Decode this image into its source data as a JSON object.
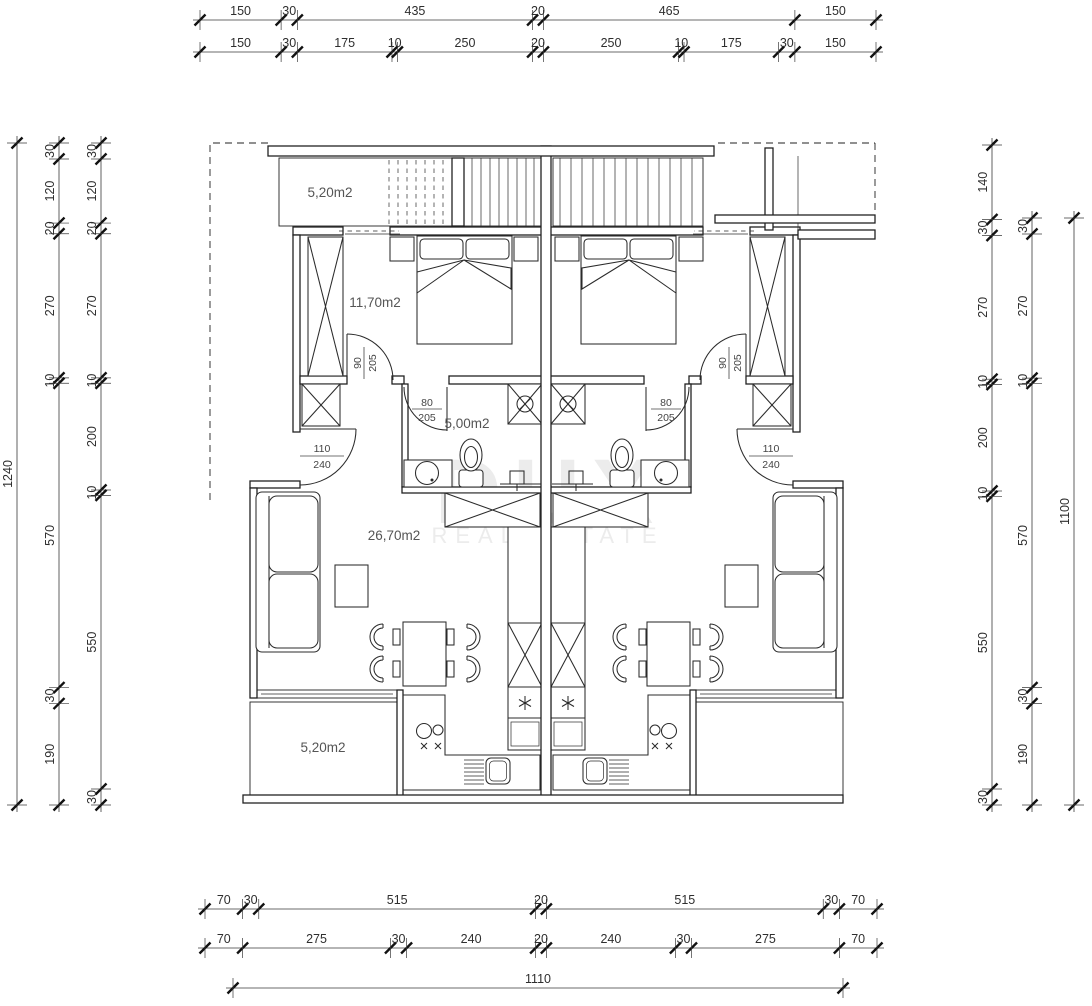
{
  "watermark": {
    "line1": "DUX",
    "line2": "REAL ESTATE"
  },
  "rooms": {
    "balcony_top": "5,20m2",
    "bedroom": "11,70m2",
    "bathroom": "5,00m2",
    "living": "26,70m2",
    "terrace_bottom": "5,20m2"
  },
  "doors": {
    "bedroom_left": {
      "w": "90",
      "h": "205"
    },
    "bedroom_right": {
      "w": "90",
      "h": "205"
    },
    "bath_left": {
      "w": "80",
      "h": "205"
    },
    "bath_right": {
      "w": "80",
      "h": "205"
    },
    "entry_left": {
      "w": "110",
      "h": "240"
    },
    "entry_right": {
      "w": "110",
      "h": "240"
    }
  },
  "dimensions": {
    "top_outer": [
      150,
      30,
      435,
      20,
      465,
      150
    ],
    "top_inner": [
      150,
      30,
      175,
      10,
      250,
      20,
      250,
      10,
      175,
      30,
      150
    ],
    "bottom_inner": [
      70,
      30,
      515,
      20,
      515,
      30,
      70
    ],
    "bottom_mid": [
      70,
      275,
      30,
      240,
      20,
      240,
      30,
      275,
      70
    ],
    "bottom_total": [
      1110
    ],
    "left_outer": [
      1240
    ],
    "left_mid": [
      30,
      120,
      20,
      270,
      10,
      570,
      30,
      190
    ],
    "left_inner": [
      30,
      120,
      20,
      270,
      10,
      200,
      10,
      550,
      30
    ],
    "right_inner": [
      140,
      30,
      270,
      10,
      200,
      10,
      550,
      30
    ],
    "right_mid": [
      30,
      270,
      10,
      570,
      30,
      190
    ],
    "right_outer": [
      1100
    ]
  }
}
